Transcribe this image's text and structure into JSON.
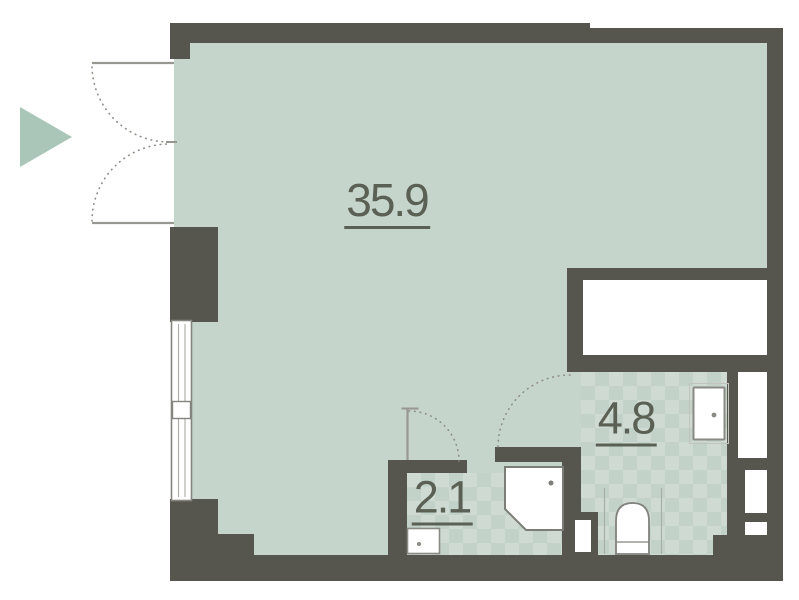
{
  "floor_plan": {
    "rooms": [
      {
        "id": "main-room",
        "area": "35.9"
      },
      {
        "id": "bathroom",
        "area": "4.8"
      },
      {
        "id": "wc-shower",
        "area": "2.1"
      }
    ],
    "entrance": {
      "indicator": "arrow-right"
    },
    "colors": {
      "wall": "#56554e",
      "floor": "#c6d5cb",
      "tile_base": "#cfdbd2",
      "tile_diamond": "#c2d2c8",
      "arrow": "#a9c6b8",
      "label_text": "#5b6055",
      "fixture_stroke": "#7d7d77",
      "door_line": "#989892"
    }
  }
}
